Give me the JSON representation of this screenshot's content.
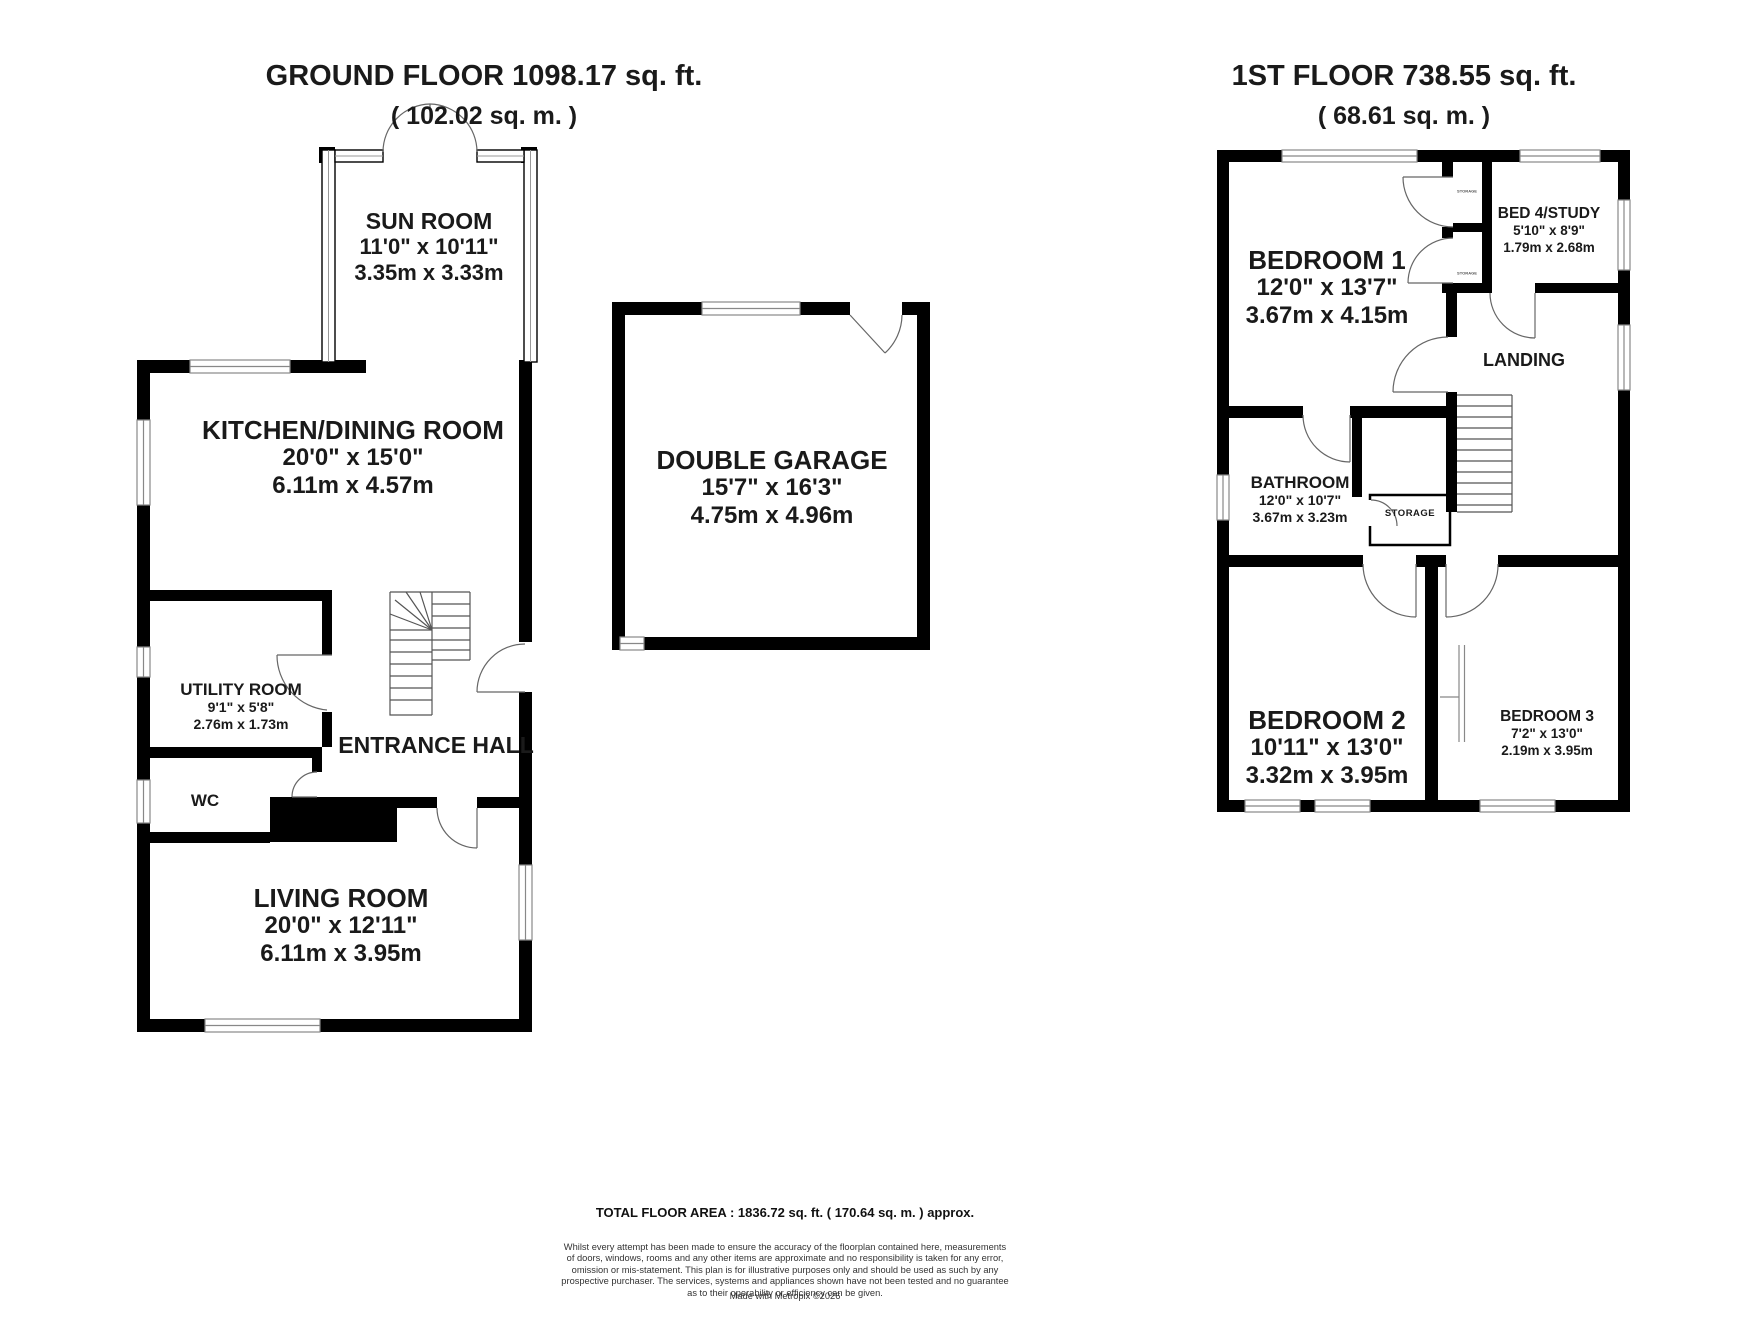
{
  "ground_floor": {
    "title": "GROUND FLOOR 1098.17 sq. ft.",
    "subtitle": "( 102.02 sq. m. )",
    "sun_room": {
      "name": "SUN ROOM",
      "imperial": "11'0\" x 10'11\"",
      "metric": "3.35m x 3.33m"
    },
    "kitchen_dining": {
      "name": "KITCHEN/DINING ROOM",
      "imperial": "20'0\" x 15'0\"",
      "metric": "6.11m x 4.57m"
    },
    "double_garage": {
      "name": "DOUBLE GARAGE",
      "imperial": "15'7\" x 16'3\"",
      "metric": "4.75m x 4.96m"
    },
    "utility_room": {
      "name": "UTILITY ROOM",
      "imperial": "9'1\" x 5'8\"",
      "metric": "2.76m x 1.73m"
    },
    "entrance_hall": {
      "name": "ENTRANCE HALL"
    },
    "wc": {
      "name": "WC"
    },
    "living_room": {
      "name": "LIVING ROOM",
      "imperial": "20'0\" x 12'11\"",
      "metric": "6.11m x 3.95m"
    }
  },
  "first_floor": {
    "title": "1ST FLOOR 738.55 sq. ft.",
    "subtitle": "( 68.61 sq. m. )",
    "bedroom_1": {
      "name": "BEDROOM 1",
      "imperial": "12'0\" x 13'7\"",
      "metric": "3.67m x 4.15m"
    },
    "bed_4_study": {
      "name": "BED 4/STUDY",
      "imperial": "5'10\" x 8'9\"",
      "metric": "1.79m x 2.68m"
    },
    "landing": {
      "name": "LANDING"
    },
    "bathroom": {
      "name": "BATHROOM",
      "imperial": "12'0\" x 10'7\"",
      "metric": "3.67m x 3.23m"
    },
    "storage": {
      "name": "STORAGE"
    },
    "closet_label": "STORAGE",
    "bedroom_2": {
      "name": "BEDROOM 2",
      "imperial": "10'11\" x 13'0\"",
      "metric": "3.32m x 3.95m"
    },
    "bedroom_3": {
      "name": "BEDROOM 3",
      "imperial": "7'2\" x 13'0\"",
      "metric": "2.19m x 3.95m"
    }
  },
  "footer": {
    "total_area": "TOTAL FLOOR AREA : 1836.72 sq. ft. ( 170.64 sq. m. ) approx.",
    "disclaimer": "Whilst every attempt has been made to ensure the accuracy of the floorplan contained here, measurements\nof doors, windows, rooms and any other items are approximate and no responsibility is taken for any error,\nomission or mis-statement. This plan is for illustrative purposes only and should be used as such by any\nprospective purchaser. The services, systems and appliances shown have not been tested and no guarantee\nas to their operability or efficiency can be given.",
    "credit": "Made with Metropix ©2026"
  },
  "colors": {
    "wall": "#000000",
    "text": "#1a1a1a",
    "door_line": "#666666",
    "window_line": "#888888"
  }
}
